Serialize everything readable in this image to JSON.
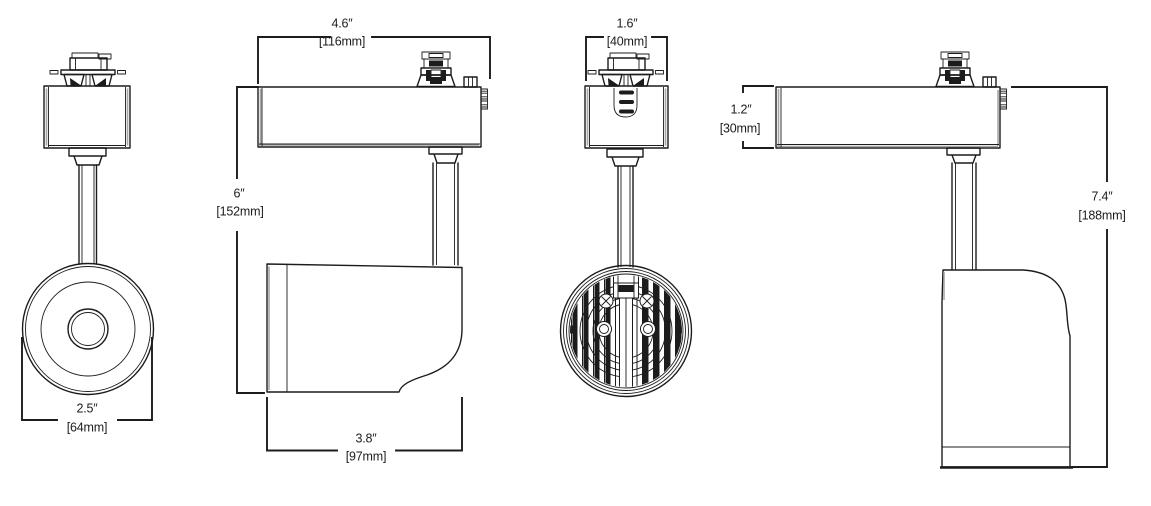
{
  "dimensions": {
    "lens_diameter": {
      "inches": "2.5″",
      "metric": "[64mm]"
    },
    "housing_width": {
      "inches": "4.6″",
      "metric": "[116mm]"
    },
    "mount_to_head": {
      "inches": "6″",
      "metric": "[152mm]"
    },
    "head_length": {
      "inches": "3.8″",
      "metric": "[97mm]"
    },
    "adapter_width": {
      "inches": "1.6″",
      "metric": "[40mm]"
    },
    "housing_height": {
      "inches": "1.2″",
      "metric": "[30mm]"
    },
    "overall_height": {
      "inches": "7.4″",
      "metric": "[188mm]"
    }
  },
  "colors": {
    "line": "#1c1c1c",
    "shade": "#a6a6a6",
    "background": "#ffffff"
  }
}
